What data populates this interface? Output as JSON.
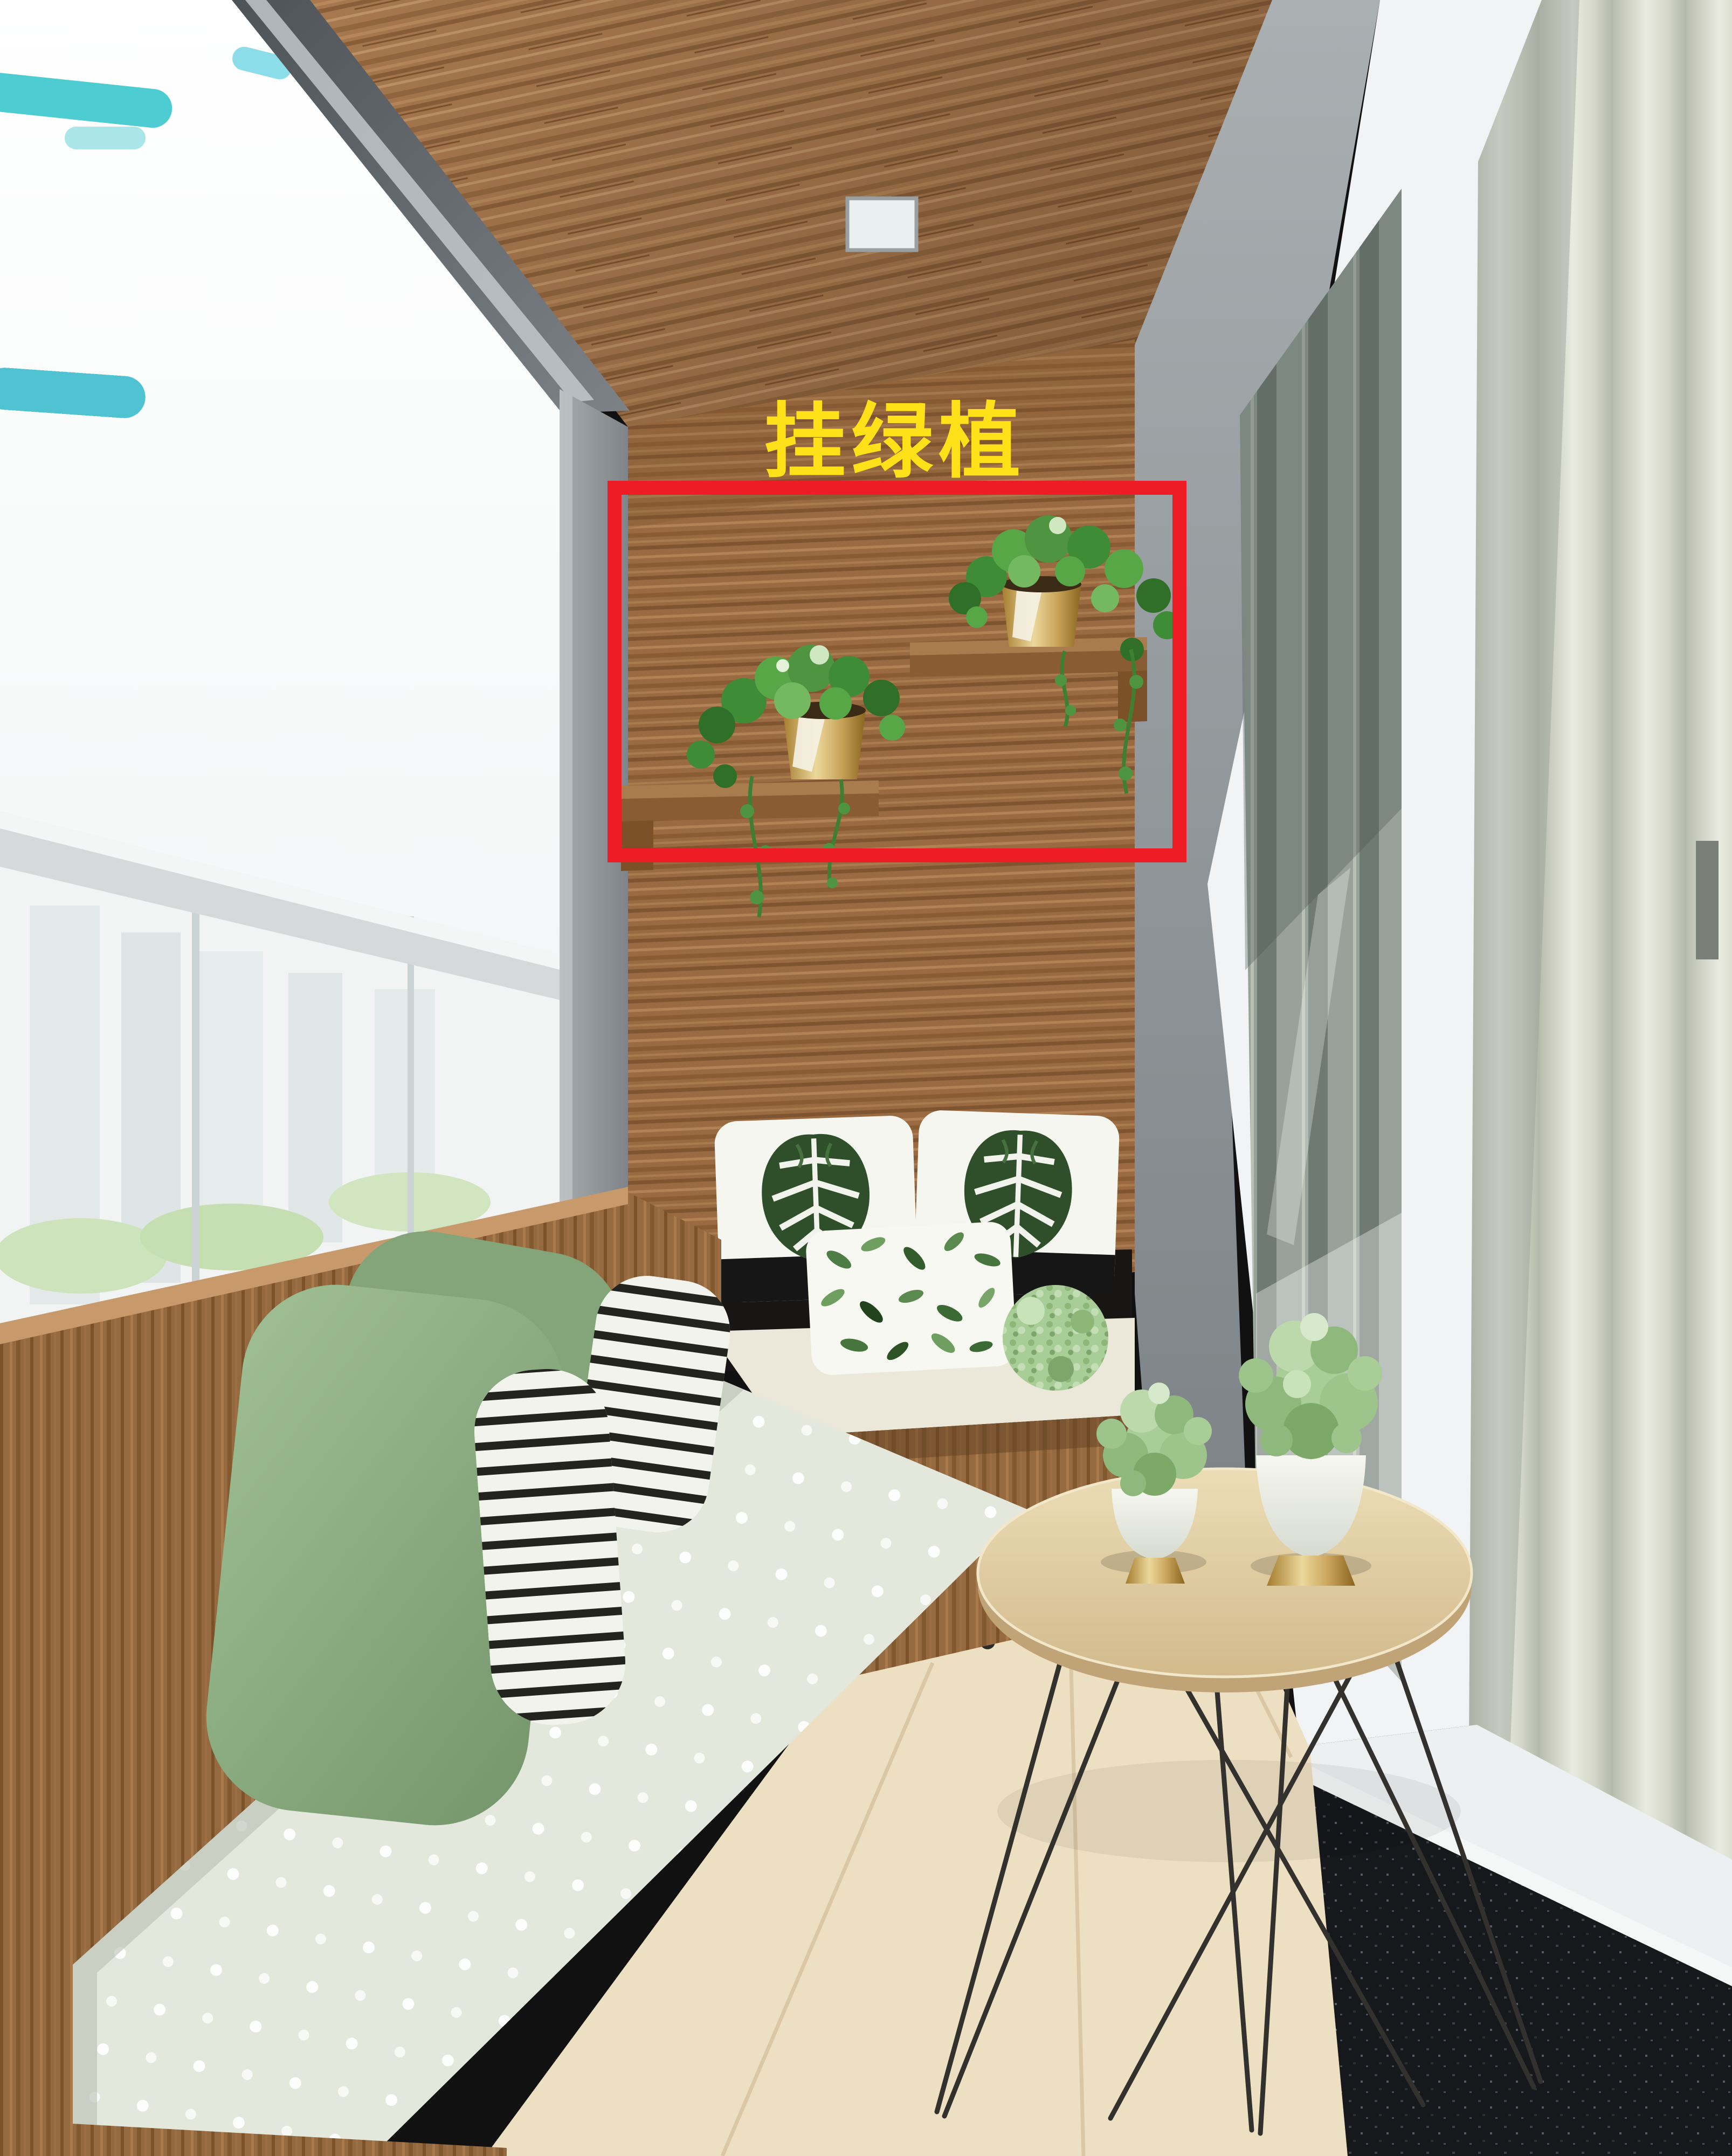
{
  "annotation": {
    "label": "挂绿植",
    "label_color": "#ffe11a",
    "label_outline": "#7a5a00",
    "box_color": "#ee1c25"
  },
  "colors": {
    "ceiling_wood": "#a87950",
    "wall_wood": "#9a6b42",
    "bench_wood": "#966a40",
    "floor_wood": "#ecdfc2",
    "cushion": "#e3e7dc",
    "pillow_green": "#8fae85",
    "pillow_stripe_dark": "#23231f",
    "monstera_leaf_green": "#2f4f2a",
    "curtain": "#d4d7ca",
    "granite": "#17191c",
    "concrete": "#969b9e",
    "frame_white": "#f1f3f4",
    "plant_green": "#4f9440",
    "pot_gold": "#c9a35a",
    "sky_teal": "#2ec4c9"
  },
  "scene": {
    "description": "Rendered narrow balcony: wood plank ceiling and feature wall, two wall shelves with hanging green plants highlighted by a red annotation box labeled in yellow Chinese text, L-shaped bench with green / striped / leaf-print pillows, polka-dot cushion, round hairpin-leg side table with two potted plants, glass sliding door and vertical blinds at right, bright city-view window at left",
    "objects": [
      "wood-ceiling",
      "recessed-ceiling-light",
      "window-city-view",
      "railing-bar",
      "wood-feature-wall",
      "upper-plant-shelf",
      "lower-plant-shelf",
      "hanging-plant-upper",
      "hanging-plant-lower",
      "l-shaped-bench",
      "green-pillows",
      "striped-pillows",
      "monstera-print-pillows",
      "leaf-print-pillow",
      "polka-dot-cushion",
      "pom-plant",
      "round-side-table",
      "potted-plant-small",
      "potted-plant-large",
      "sliding-glass-door",
      "vertical-blinds",
      "granite-sill",
      "wood-floor"
    ]
  }
}
